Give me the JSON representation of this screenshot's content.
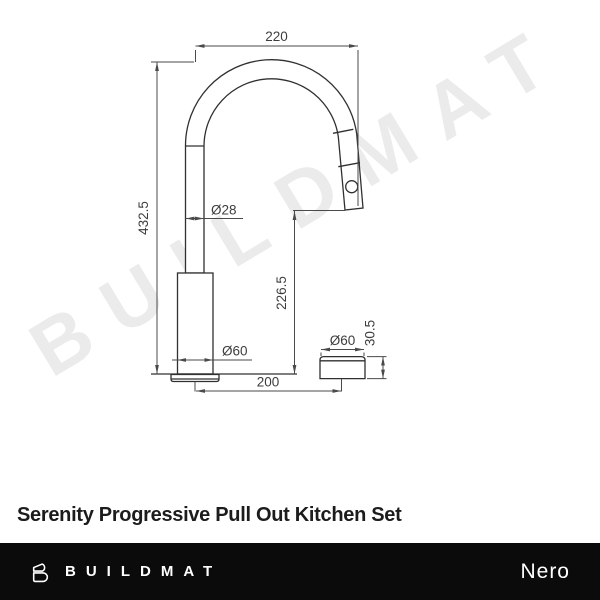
{
  "watermark": {
    "text": "BUILDMAT"
  },
  "drawing": {
    "dimensions": {
      "spout_reach": "220",
      "overall_height": "432.5",
      "spout_diameter": "Ø28",
      "outlet_height": "226.5",
      "base_diameter": "Ø60",
      "centre_spacing": "200",
      "mixer_diameter": "Ø60",
      "mixer_height": "30.5"
    }
  },
  "product": {
    "title": "Serenity Progressive Pull Out Kitchen Set"
  },
  "footer": {
    "brand": "BUILDMAT",
    "collection": "Nero"
  },
  "colors": {
    "object_line": "#303030",
    "dimension_line": "#4a4a4a",
    "watermark": "#ebebeb",
    "footer_bg": "#0b0b0b",
    "title_text": "#1c1c1c"
  }
}
